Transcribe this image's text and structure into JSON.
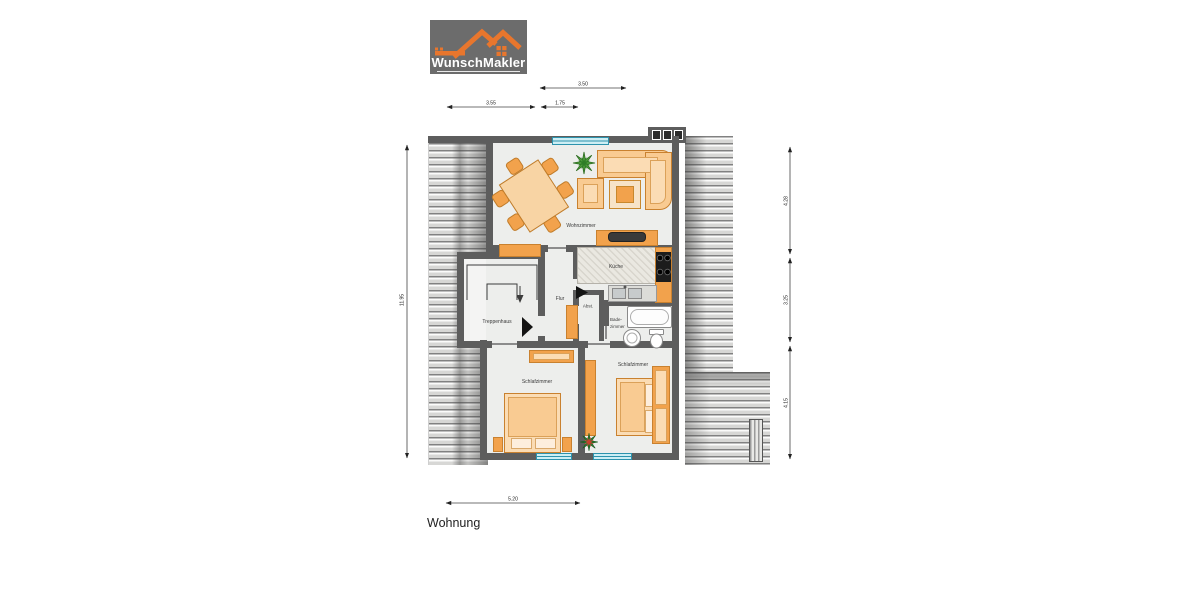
{
  "logo": {
    "brand": "WunschMakler"
  },
  "caption": "Wohnung",
  "dimensions": {
    "top": "3.50",
    "upper_left": "3.55",
    "upper_mid": "1.75",
    "left": "11.95",
    "right_top": "4.28",
    "right_middle": "3.25",
    "right_bottom": "4.15",
    "bottom": "5.20"
  },
  "rooms": {
    "living": "Wohnzimmer",
    "kitchen": "Küche",
    "hall": "Flur",
    "storage": "Abst.",
    "bath_line1": "Bade-",
    "bath_line2": "zimmer",
    "stairwell": "Treppenhaus",
    "bedroom_left": "Schlafzimmer",
    "bedroom_right": "Schlafzimmer"
  },
  "colors": {
    "brand_orange": "#e8762d",
    "furniture_orange": "#f2a24c",
    "furniture_light": "#f9cb92",
    "wall_gray": "#5d5d5d",
    "window_cyan": "#cdeef4",
    "logo_gray": "#6c6c6c"
  }
}
